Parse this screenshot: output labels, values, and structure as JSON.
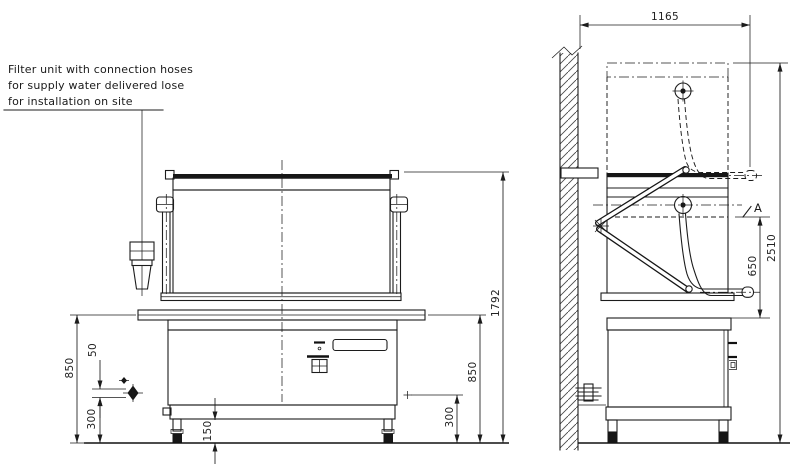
{
  "note": {
    "line1": "Filter unit with connection hoses",
    "line2": "for supply water delivered lose",
    "line3": "for installation on site"
  },
  "dimensions": {
    "top_width": "1165",
    "overall_height": "2510",
    "hood_clearance": "650",
    "front_total_height": "1792",
    "table_height_left": "850",
    "table_height_right": "850",
    "connection_offset": "50",
    "connection_height_left": "300",
    "connection_height_right": "300",
    "leg_height": "150"
  },
  "marks": {
    "section_label": "A"
  },
  "colors": {
    "line": "#1c1c1c",
    "background": "#ffffff",
    "text": "#222222"
  }
}
